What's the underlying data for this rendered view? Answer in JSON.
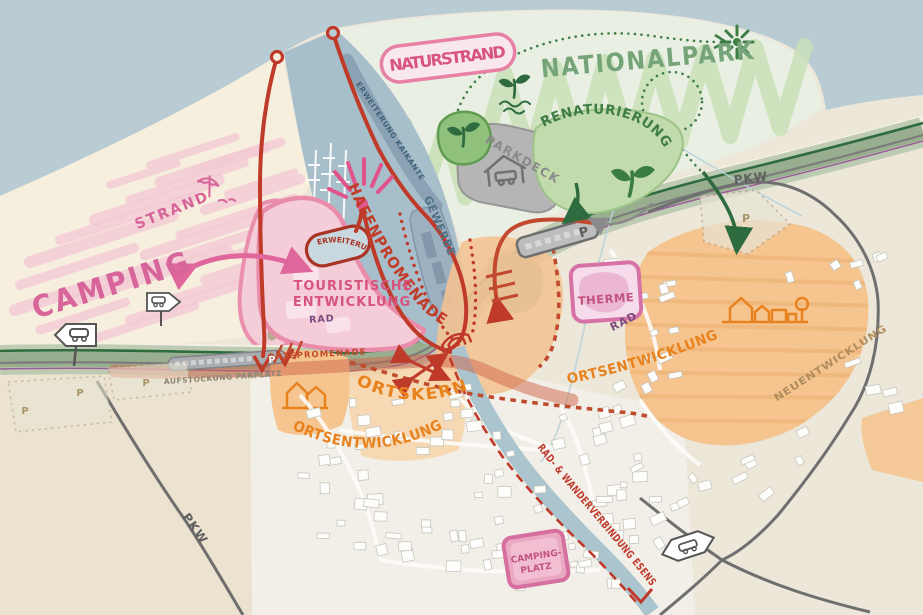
{
  "map_labels": {
    "naturstrand": "NATURSTRAND",
    "nationalpark": "NATIONALPARK",
    "renaturierung": "RENATURIERUNG",
    "parkdeck": "PARKDECK",
    "gewerbe": "GEWERBE",
    "erweiterung_kaikante": "ERWEITERUNG KAIKANTE",
    "hafenpromenade": "HAFENPROMENADE",
    "erweiterung": "ERWEITERUNG",
    "touristische_1": "TOURISTISCHE",
    "touristische_2": "ENTWICKLUNG",
    "strand": "STRAND",
    "camping": "CAMPING",
    "aufstockung": "AUFSTOCKUNG PARPLATZ",
    "ortspromenade": "ORTSPROMENADE",
    "ortskern": "ORTSKERN",
    "ortsentwicklung": "ORTSENTWICKLUNG",
    "neuentwicklung": "NEUENTWICKLUNG",
    "therme": "THERME",
    "rad": "RAD",
    "pkw": "PKW",
    "campingplatz_1": "CAMPING-",
    "campingplatz_2": "PLATZ",
    "rad_wander": "RAD- & WANDERVERBINDUNG ESENS",
    "parking": "P"
  },
  "colors": {
    "sea": "#b9cbd3",
    "sand": "#f7efde",
    "land": "#ece7d9",
    "park_green": "#c9dfb7",
    "accent_pink": "#d8547e",
    "route_red": "#bf3a28",
    "dev_orange": "#e8821e",
    "area_orange": "#f5c48f",
    "slate_blue": "#8ba2b5",
    "band_green": "#a8bda0",
    "dark_green": "#2e6b3e",
    "purple": "#9a5c96",
    "road_gray": "#6f6f6f"
  }
}
